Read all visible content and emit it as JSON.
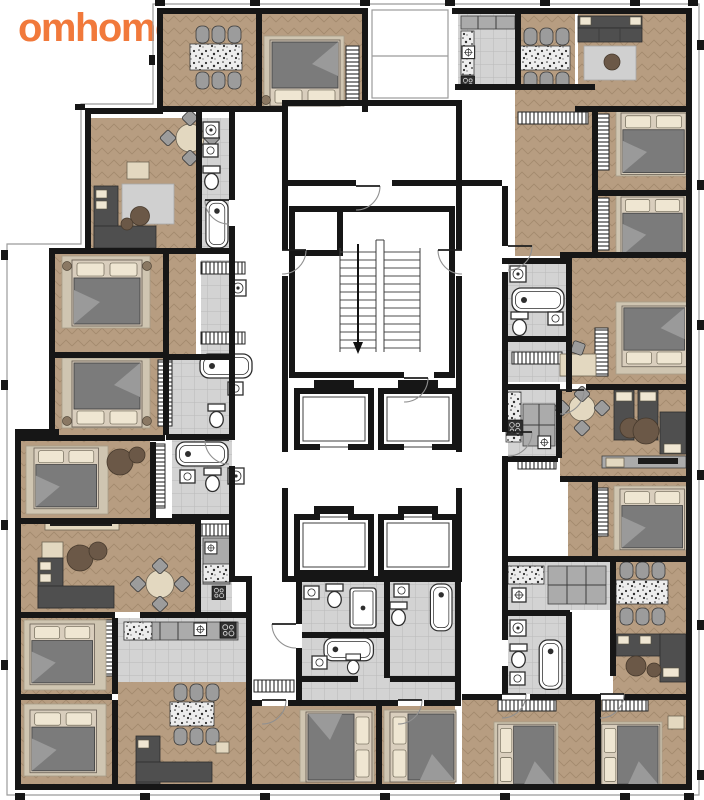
{
  "logo": {
    "text": "omhome"
  },
  "colors": {
    "brand_orange": "#F1793B",
    "background": "#FFFFFF",
    "wall": "#161616",
    "wood_floor": "#B79D81",
    "wood_line": "#A0876B",
    "tile_floor": "#D3D3D3",
    "tile_line": "#BABABA",
    "granite_bg": "#EDEDED",
    "granite_dot": "#2E2E2E",
    "counter_gray": "#ABABAB",
    "furniture_dark": "#4F4F4F",
    "duvet_gray": "#7B7B7B",
    "duvet_fold": "#9A9A9A",
    "pillow_cream": "#EFE6D2",
    "bed_frame": "#D9CEBD",
    "rug_beige": "#CFC5B1",
    "mat_gray": "#D0D0D0",
    "armchair_beige": "#E3D8C0",
    "fixture_white": "#FFFFFF",
    "fixture_line": "#2E2E2E",
    "pouf_brown": "#6B5847",
    "chair_gray": "#9C9C9C",
    "hatch_line": "#262626",
    "facade_line": "#9B9B9B"
  }
}
